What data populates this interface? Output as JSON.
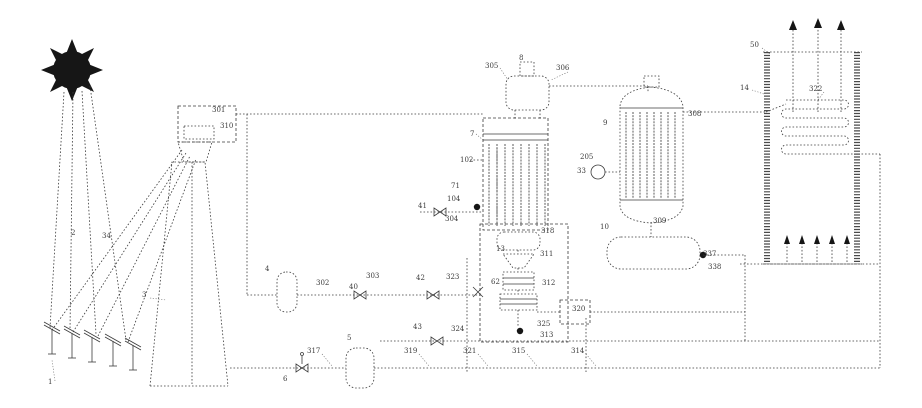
{
  "figure": {
    "background": "#ffffff",
    "ink_color": "#3b3b3b",
    "kind": "patent process flow diagram"
  },
  "icons": [
    {
      "name": "sun-icon"
    },
    {
      "name": "up-arrow-icon"
    },
    {
      "name": "valve-bowtie-icon"
    },
    {
      "name": "pump-dot-icon"
    }
  ],
  "labels": [
    {
      "t": "1",
      "x": 48,
      "y": 378
    },
    {
      "t": "2",
      "x": 71,
      "y": 229
    },
    {
      "t": "34",
      "x": 102,
      "y": 232
    },
    {
      "t": "3",
      "x": 142,
      "y": 291
    },
    {
      "t": "301",
      "x": 212,
      "y": 106
    },
    {
      "t": "310",
      "x": 220,
      "y": 122
    },
    {
      "t": "4",
      "x": 265,
      "y": 265
    },
    {
      "t": "302",
      "x": 316,
      "y": 279
    },
    {
      "t": "40",
      "x": 349,
      "y": 283
    },
    {
      "t": "303",
      "x": 366,
      "y": 272
    },
    {
      "t": "42",
      "x": 416,
      "y": 274
    },
    {
      "t": "323",
      "x": 446,
      "y": 273
    },
    {
      "t": "8",
      "x": 519,
      "y": 54
    },
    {
      "t": "305",
      "x": 485,
      "y": 62
    },
    {
      "t": "306",
      "x": 556,
      "y": 64
    },
    {
      "t": "7",
      "x": 470,
      "y": 130
    },
    {
      "t": "102",
      "x": 460,
      "y": 156
    },
    {
      "t": "71",
      "x": 451,
      "y": 182
    },
    {
      "t": "104",
      "x": 447,
      "y": 195
    },
    {
      "t": "41",
      "x": 418,
      "y": 202
    },
    {
      "t": "304",
      "x": 445,
      "y": 215
    },
    {
      "t": "13",
      "x": 496,
      "y": 245
    },
    {
      "t": "318",
      "x": 541,
      "y": 227
    },
    {
      "t": "311",
      "x": 540,
      "y": 250
    },
    {
      "t": "62",
      "x": 491,
      "y": 278
    },
    {
      "t": "312",
      "x": 542,
      "y": 279
    },
    {
      "t": "320",
      "x": 572,
      "y": 305
    },
    {
      "t": "325",
      "x": 537,
      "y": 320
    },
    {
      "t": "313",
      "x": 540,
      "y": 331
    },
    {
      "t": "43",
      "x": 413,
      "y": 323
    },
    {
      "t": "324",
      "x": 451,
      "y": 325
    },
    {
      "t": "317",
      "x": 307,
      "y": 347
    },
    {
      "t": "5",
      "x": 347,
      "y": 334
    },
    {
      "t": "6",
      "x": 283,
      "y": 375
    },
    {
      "t": "319",
      "x": 404,
      "y": 347
    },
    {
      "t": "321",
      "x": 463,
      "y": 347
    },
    {
      "t": "315",
      "x": 512,
      "y": 347
    },
    {
      "t": "314",
      "x": 571,
      "y": 347
    },
    {
      "t": "9",
      "x": 603,
      "y": 119
    },
    {
      "t": "205",
      "x": 580,
      "y": 153
    },
    {
      "t": "33",
      "x": 577,
      "y": 167
    },
    {
      "t": "308",
      "x": 688,
      "y": 110
    },
    {
      "t": "309",
      "x": 653,
      "y": 217
    },
    {
      "t": "10",
      "x": 600,
      "y": 223
    },
    {
      "t": "337",
      "x": 703,
      "y": 250
    },
    {
      "t": "338",
      "x": 708,
      "y": 263
    },
    {
      "t": "50",
      "x": 750,
      "y": 41
    },
    {
      "t": "14",
      "x": 740,
      "y": 84
    },
    {
      "t": "322",
      "x": 809,
      "y": 85
    }
  ]
}
